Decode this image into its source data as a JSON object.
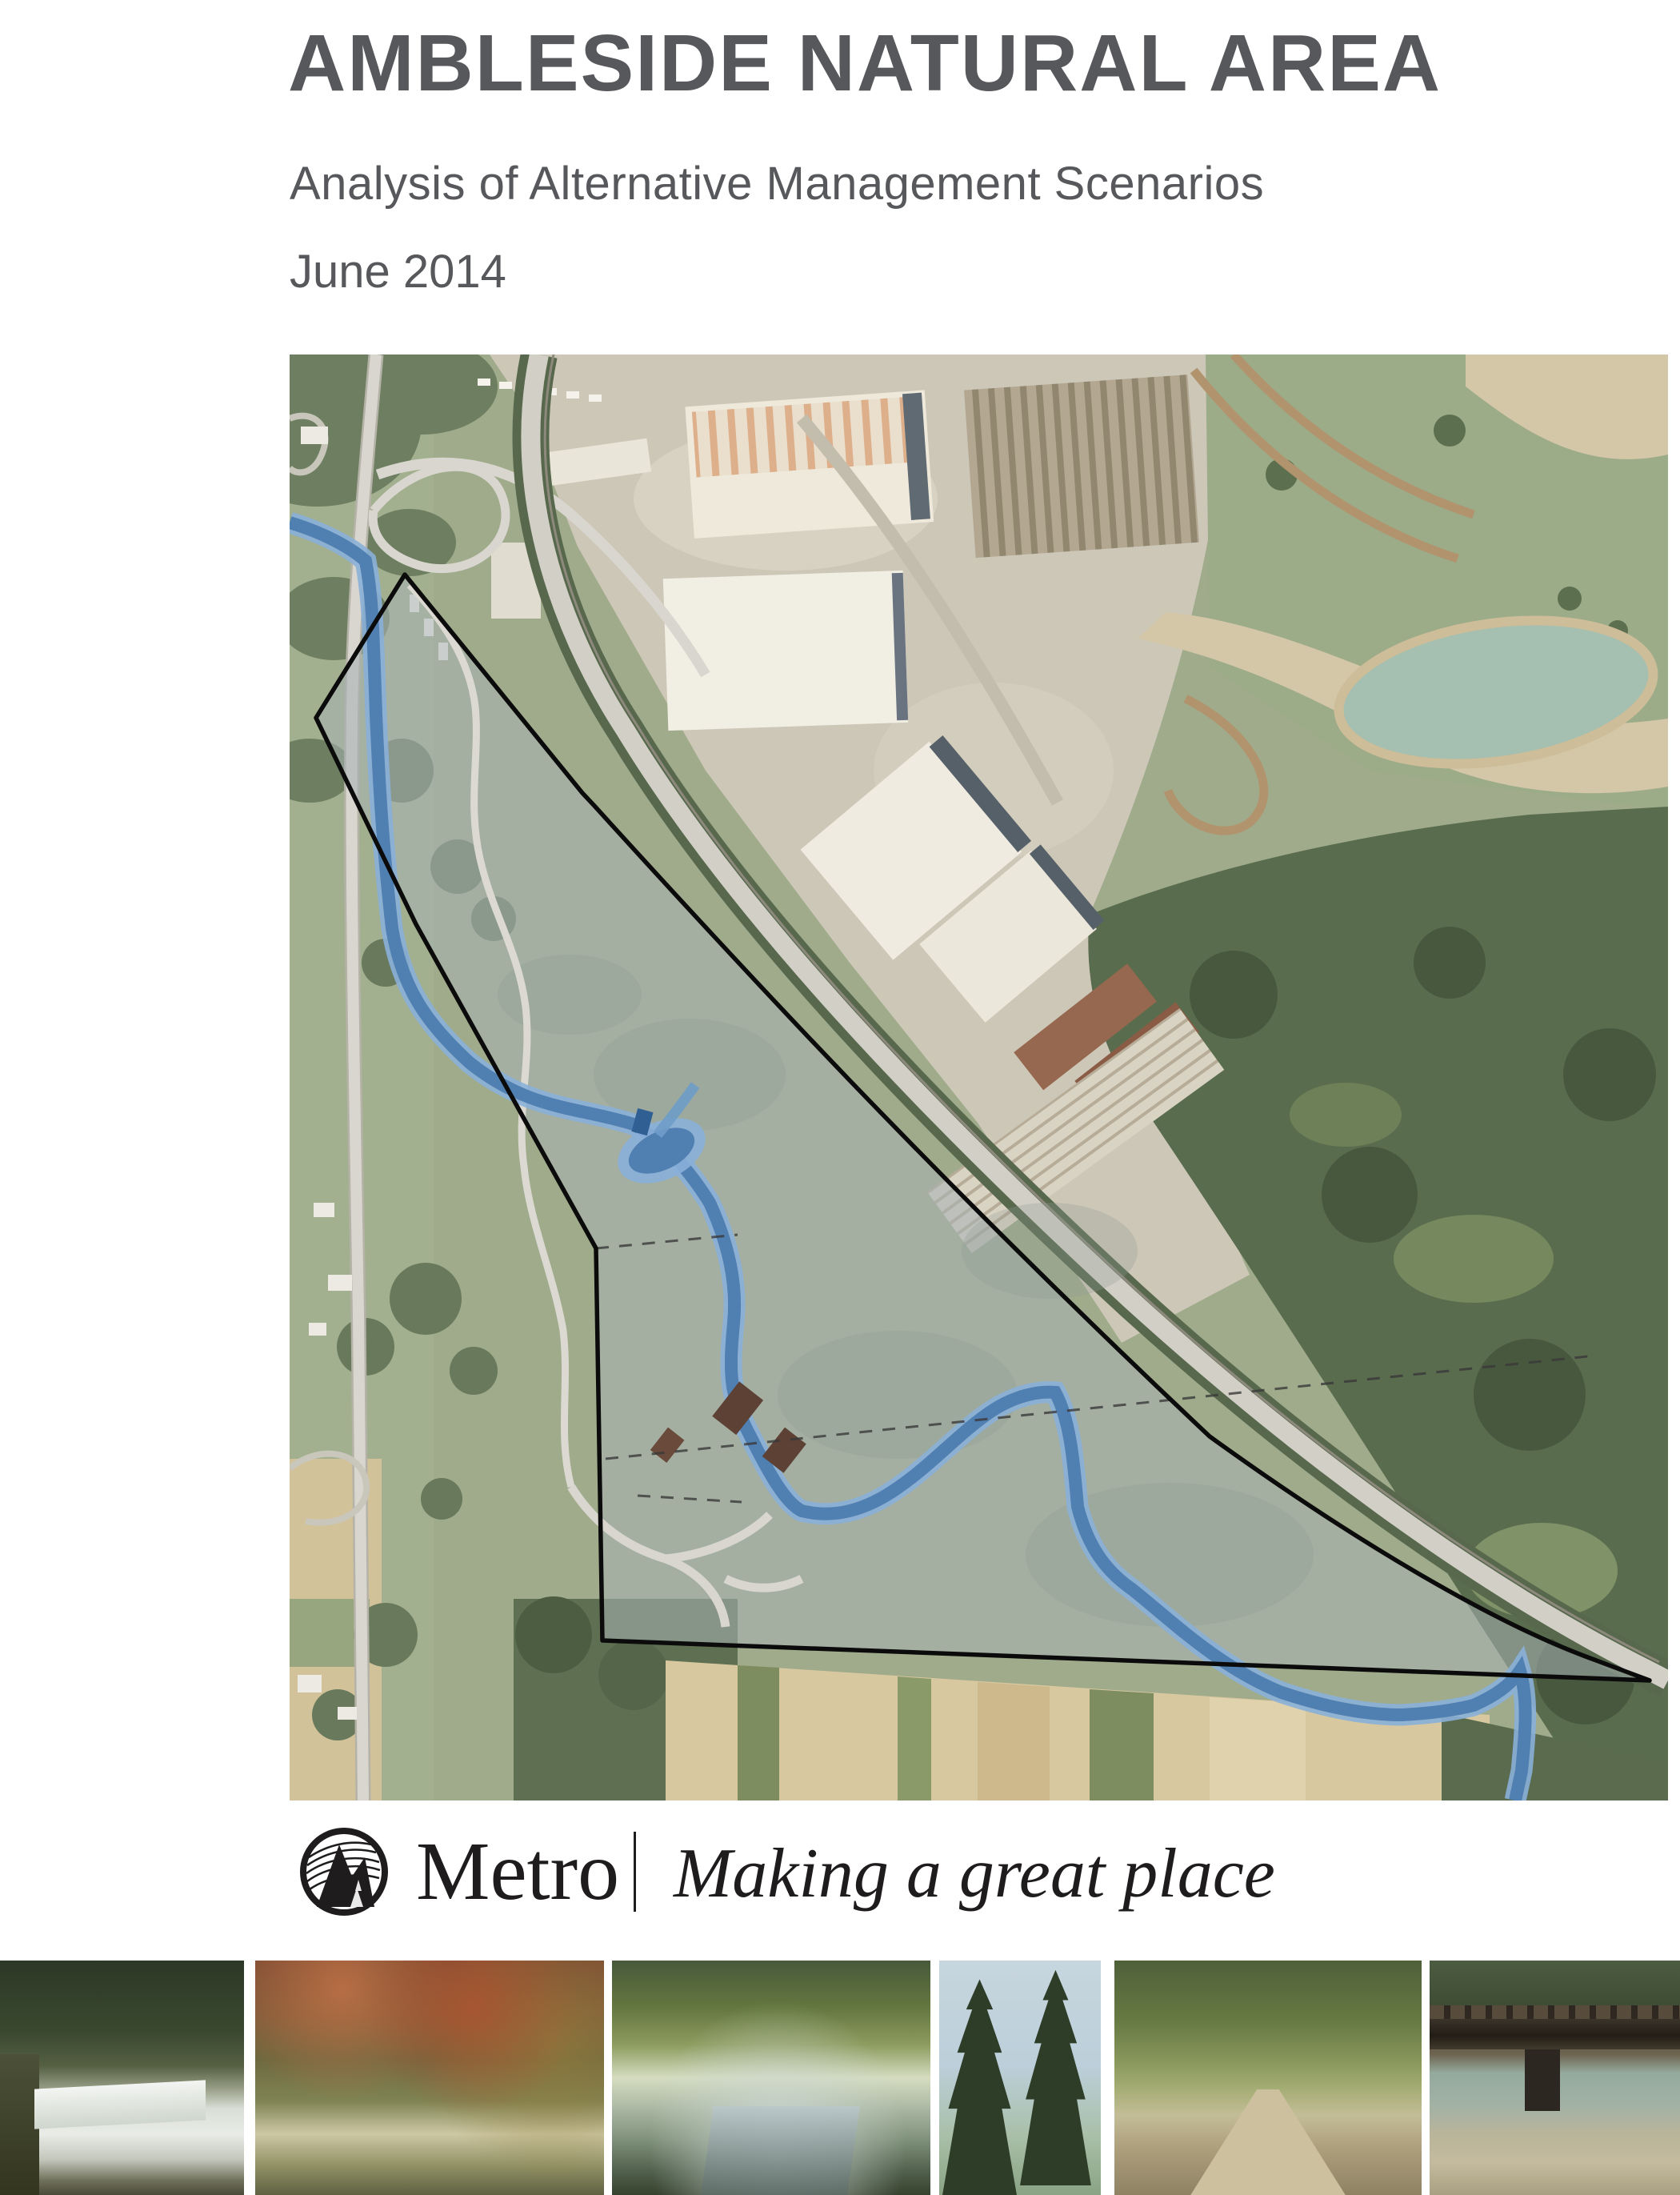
{
  "header": {
    "title": "AMBLESIDE NATURAL AREA",
    "subtitle": "Analysis of Alternative Management Scenarios",
    "date": "June 2014",
    "text_color": "#57585b"
  },
  "map": {
    "alt": "Aerial photograph of the Ambleside Natural Area site with black property boundary outline, gray site overlay, blue highlighted river channel, adjacent highway, industrial yard with warehouses, quarry pond and surrounding farm fields and forest",
    "site_overlay_color": "#a8b2b5",
    "boundary_color": "#0b0b0b",
    "river_color": "#4d7cb0",
    "highway_color": "#d2cfc6"
  },
  "footer": {
    "brand": "Metro",
    "tagline": "Making a great place",
    "color": "#1f1c1d"
  },
  "photos": {
    "items": [
      {
        "label": "forested stream with small dam and waterfall"
      },
      {
        "label": "autumn maple canopy over stream"
      },
      {
        "label": "creek flowing through dense green vegetation"
      },
      {
        "label": "tall conifer trees against pale sky"
      },
      {
        "label": "tree-lined gravel path"
      },
      {
        "label": "wooden bridge over creek with grassy bank"
      }
    ]
  }
}
